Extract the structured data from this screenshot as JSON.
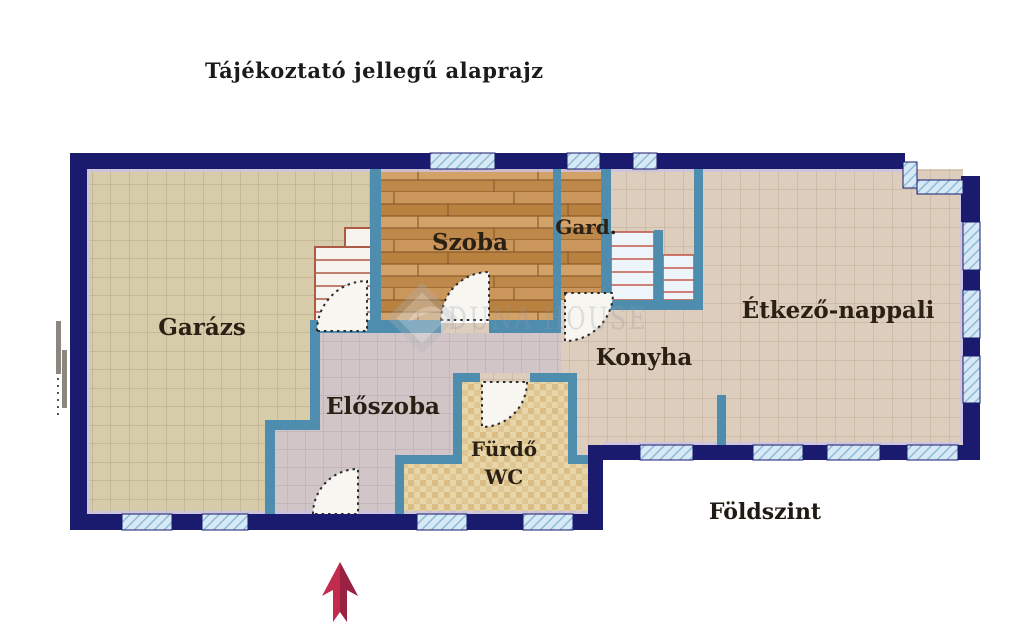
{
  "title": "Tájékoztató jellegű alaprajz",
  "floor_label": "Földszint",
  "watermark_brand": "DUNA HOUSE",
  "rooms": {
    "garage": "Garázs",
    "room": "Szoba",
    "wardrobe": "Gard.",
    "dining_living": "Étkező-nappali",
    "kitchen": "Konyha",
    "hallway": "Előszoba",
    "bathroom": "Fürdő",
    "wc": "WC"
  },
  "compass": {
    "north_arrow": "north"
  },
  "colors": {
    "wall_outer": "#1a1a6e",
    "wall_inner": "#4e8dae",
    "window_fill": "#d6e9f5",
    "window_hatch": "#8fbad9",
    "tile_garage": "#d7ccaa",
    "tile_living": "#ddcdbd",
    "tile_hall": "#d2c5c8",
    "tile_bath": "#e8d6a9",
    "wood": "#c9945c",
    "stair_red": "#c05a4a",
    "arrow": "#c22b4c",
    "arrow_dark": "#8e2140",
    "watermark": "#8f97a3",
    "trim": "#cbc3e3"
  }
}
